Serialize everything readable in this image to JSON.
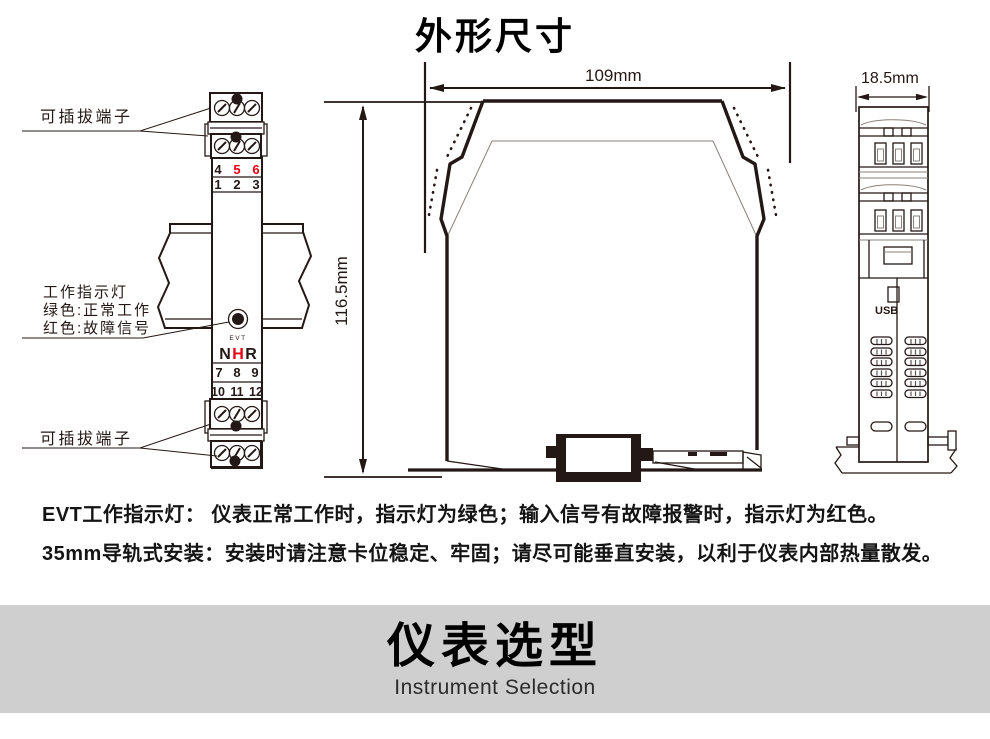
{
  "page": {
    "title": "外形尺寸"
  },
  "left_view": {
    "plug_terminal_top": "可插拔端子",
    "plug_terminal_bottom": "可插拔端子",
    "indicator_line1": "工作指示灯",
    "indicator_line2": "绿色:正常工作",
    "indicator_line3": "红色:故障信号",
    "evt_label": "EVT",
    "logo": {
      "n": "N",
      "h": "H",
      "r": "R"
    },
    "terminals": {
      "row1": [
        "4",
        "5",
        "6"
      ],
      "row2": [
        "1",
        "2",
        "3"
      ],
      "row3": [
        "7",
        "8",
        "9"
      ],
      "row4": [
        "10",
        "11",
        "12"
      ]
    }
  },
  "front_view": {
    "width_label": "109mm",
    "height_label": "116.5mm"
  },
  "side_view": {
    "width_label": "18.5mm",
    "usb_label": "USB"
  },
  "notes": [
    "EVT工作指示灯： 仪表正常工作时，指示灯为绿色；输入信号有故障报警时，指示灯为红色。",
    "35mm导轨式安装：安装时请注意卡位稳定、牢固；请尽可能垂直安装，以利于仪表内部热量散发。"
  ],
  "banner": {
    "title": "仪表选型",
    "subtitle": "Instrument Selection"
  },
  "colors": {
    "line": "#231815",
    "accent_red": "#e60012",
    "banner_bg": "#d0cfcf"
  }
}
